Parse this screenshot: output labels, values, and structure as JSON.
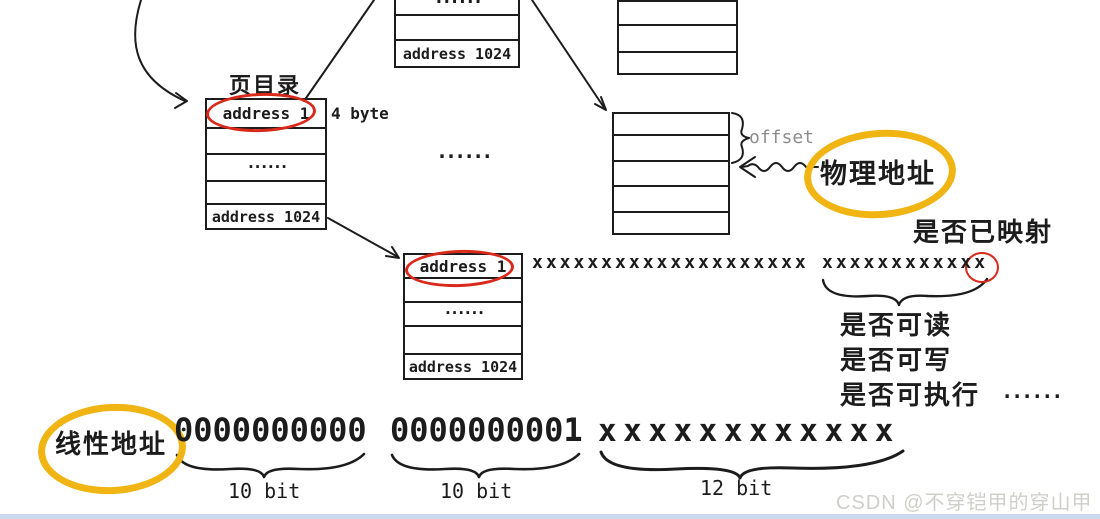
{
  "page_directory": {
    "caption": "页目录",
    "entry_size": "4 byte",
    "rows": [
      "address 1",
      "",
      "......",
      "",
      "address 1024"
    ]
  },
  "upper_page_table": {
    "rows": [
      "......",
      "",
      "address 1024"
    ]
  },
  "upper_right_frame": {
    "rows": [
      "",
      "",
      ""
    ]
  },
  "mid_page_table": {
    "rows": [
      "address 1",
      "",
      "......",
      "",
      "address 1024"
    ]
  },
  "physical_frame": {
    "rows": [
      "",
      "",
      "",
      "",
      ""
    ],
    "offset_label": "offset"
  },
  "between_tables_ellipsis": "......",
  "physical_address_label": "物理地址",
  "pte_bits": {
    "address_bits": "xxxxxxxxxxxxxxxxxxxx",
    "flag_bits": "xxxxxxxxxxxx",
    "mapped_label": "是否已映射"
  },
  "flag_notes": {
    "readable": "是否可读",
    "writable": "是否可写",
    "executable": "是否可执行",
    "more_dots": "......"
  },
  "linear_address": {
    "label": "线性地址",
    "fields": [
      {
        "bits": "0000000000",
        "caption": "10 bit"
      },
      {
        "bits": "0000000001",
        "caption": "10 bit"
      },
      {
        "bits": "xxxxxxxxxxxx",
        "caption": "12 bit"
      }
    ]
  },
  "watermark": "CSDN @不穿铠甲的穿山甲",
  "colors": {
    "ink": "#1c1c1c",
    "red_circle": "#d9291b",
    "yellow_highlight": "#f0b513",
    "gray_label": "#8d8d8d",
    "watermark_gray": "#cfcfca",
    "bottom_strip": "#ccd9ee"
  }
}
